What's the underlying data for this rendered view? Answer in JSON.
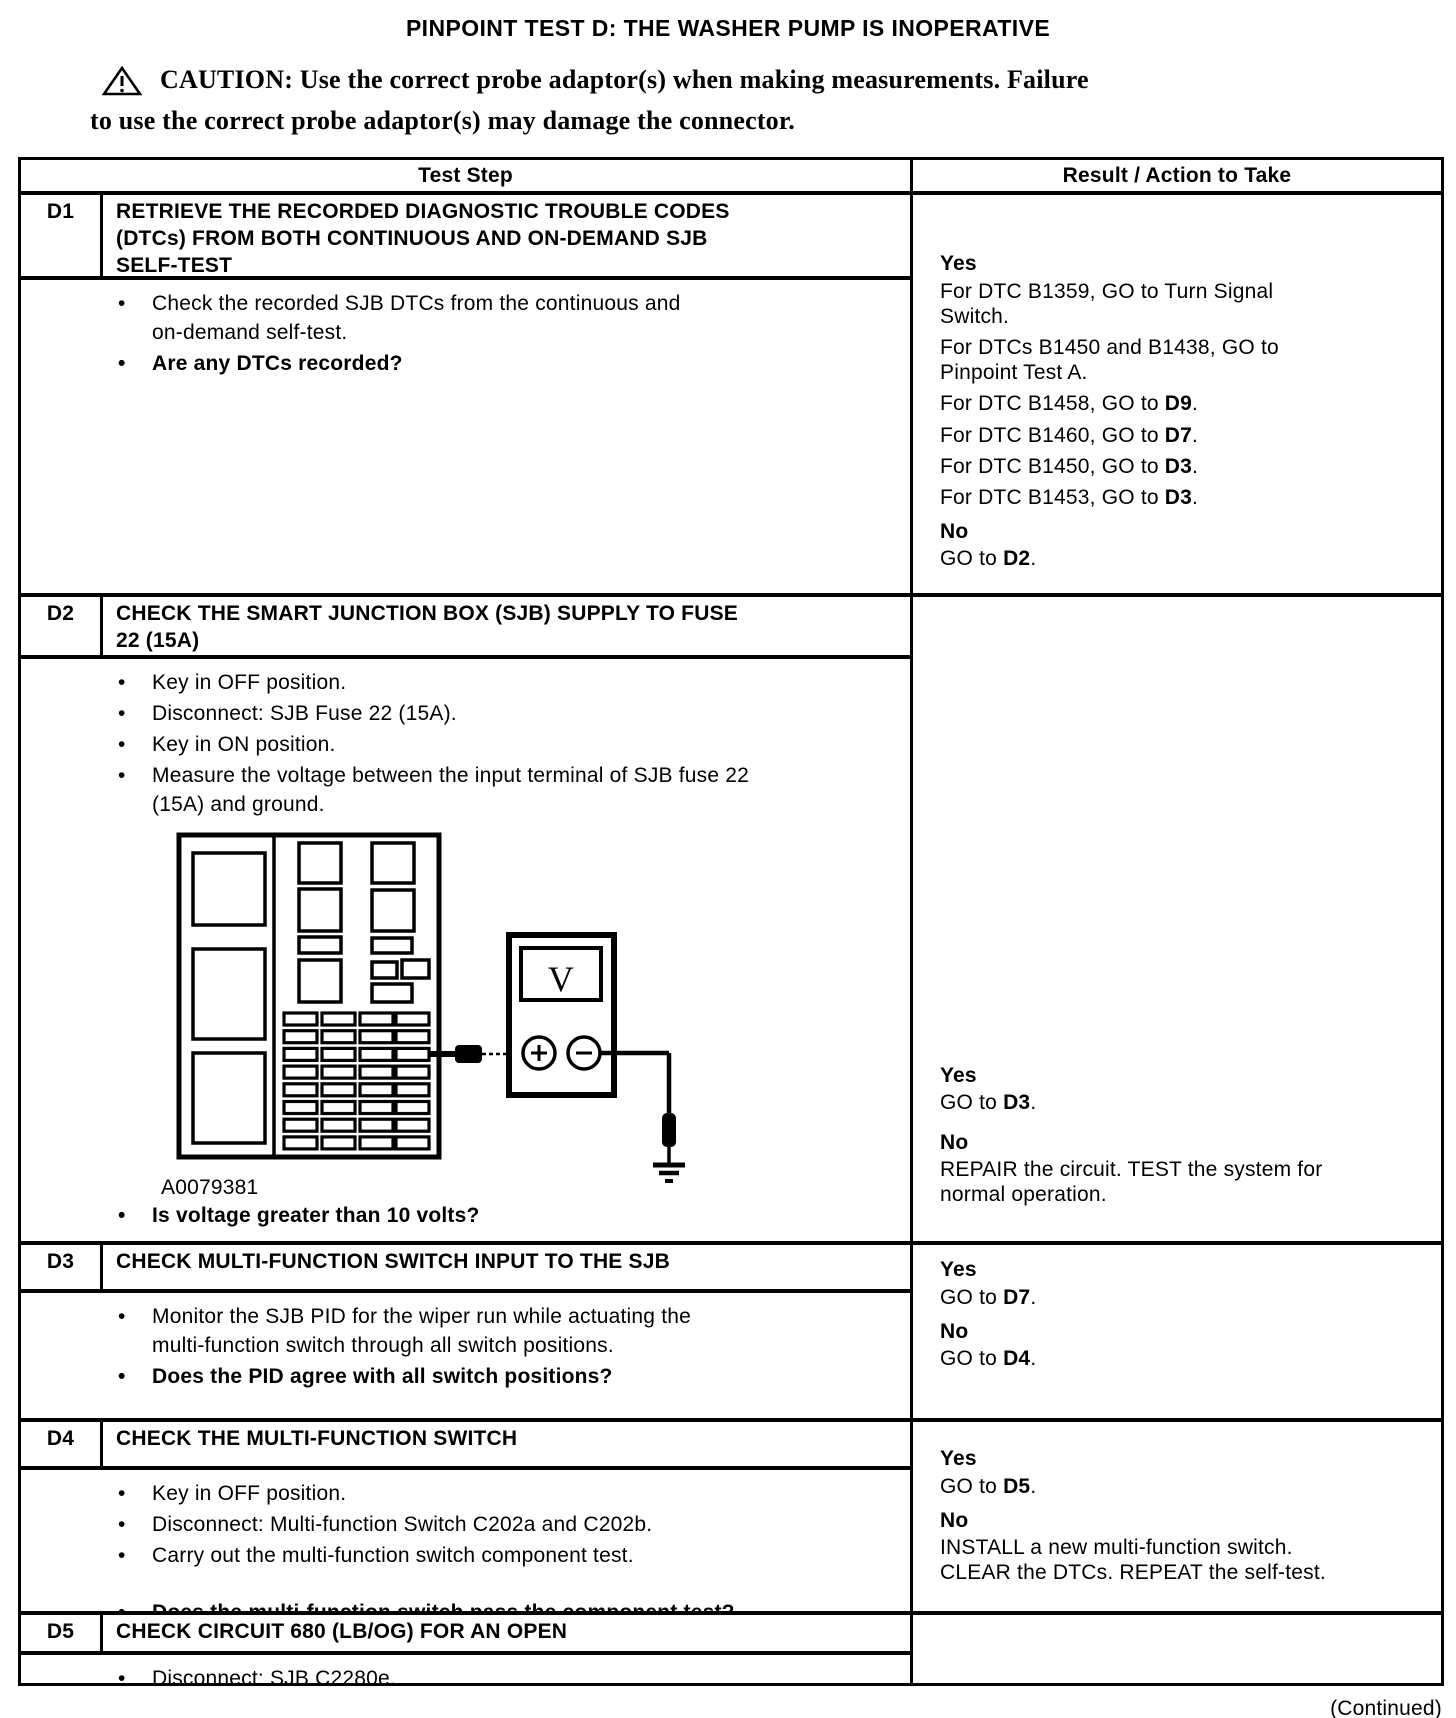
{
  "page": {
    "title": "PINPOINT TEST D: THE WASHER PUMP IS INOPERATIVE",
    "continued": "(Continued)"
  },
  "caution": {
    "line1": "CAUTION: Use the correct probe adaptor(s) when making measurements. Failure",
    "line2": "to use the correct probe adaptor(s) may damage the connector."
  },
  "table": {
    "headers": {
      "test_step": "Test Step",
      "result": "Result / Action to Take"
    },
    "rows": [
      {
        "id": "D1",
        "title": "RETRIEVE THE RECORDED DIAGNOSTIC TROUBLE CODES\n(DTCs) FROM BOTH CONTINUOUS AND ON-DEMAND SJB\nSELF-TEST",
        "steps": [
          {
            "text": "Check the recorded SJB DTCs from the continuous and\non-demand self-test."
          },
          {
            "text": "Are any DTCs recorded?",
            "bold": true
          }
        ],
        "result": [
          {
            "type": "h",
            "text": "Yes"
          },
          {
            "type": "p",
            "segments": [
              {
                "t": "For DTC B1359, GO to Turn Signal\nSwitch."
              }
            ]
          },
          {
            "type": "p",
            "segments": [
              {
                "t": "For DTCs B1450 and B1438, GO to\nPinpoint Test A."
              }
            ]
          },
          {
            "type": "p",
            "segments": [
              {
                "t": "For DTC B1458, GO to "
              },
              {
                "t": "D9",
                "b": true
              },
              {
                "t": "."
              }
            ]
          },
          {
            "type": "p",
            "segments": [
              {
                "t": "For DTC B1460, GO to "
              },
              {
                "t": "D7",
                "b": true
              },
              {
                "t": "."
              }
            ]
          },
          {
            "type": "p",
            "segments": [
              {
                "t": "For DTC B1450, GO to "
              },
              {
                "t": "D3",
                "b": true
              },
              {
                "t": "."
              }
            ]
          },
          {
            "type": "p",
            "segments": [
              {
                "t": "For DTC B1453, GO to "
              },
              {
                "t": "D3",
                "b": true
              },
              {
                "t": "."
              }
            ]
          },
          {
            "type": "h",
            "text": "No"
          },
          {
            "type": "p",
            "segments": [
              {
                "t": "GO to "
              },
              {
                "t": "D2",
                "b": true
              },
              {
                "t": "."
              }
            ]
          }
        ]
      },
      {
        "id": "D2",
        "title": "CHECK THE SMART JUNCTION BOX (SJB) SUPPLY TO FUSE\n22 (15A)",
        "steps": [
          {
            "text": "Key in OFF position."
          },
          {
            "text": "Disconnect: SJB Fuse 22 (15A)."
          },
          {
            "text": "Key in ON position."
          },
          {
            "text": "Measure the voltage between the input terminal of SJB fuse 22\n(15A) and ground."
          }
        ],
        "figure": {
          "caption": "A0079381",
          "meter_label": "V"
        },
        "steps2": [
          {
            "text": "Is voltage greater than 10 volts?",
            "bold": true
          }
        ],
        "result": [
          {
            "type": "h",
            "text": "Yes"
          },
          {
            "type": "p",
            "segments": [
              {
                "t": "GO to "
              },
              {
                "t": "D3",
                "b": true
              },
              {
                "t": "."
              }
            ]
          },
          {
            "type": "h",
            "text": "No"
          },
          {
            "type": "p",
            "segments": [
              {
                "t": "REPAIR the circuit. TEST the system for\nnormal operation."
              }
            ]
          }
        ]
      },
      {
        "id": "D3",
        "title": "CHECK MULTI-FUNCTION SWITCH INPUT TO THE SJB",
        "steps": [
          {
            "text": "Monitor the SJB PID for the wiper run while actuating the\nmulti-function switch through all switch positions."
          },
          {
            "text": "Does the PID agree with all switch positions?",
            "bold": true
          }
        ],
        "result": [
          {
            "type": "h",
            "text": "Yes"
          },
          {
            "type": "p",
            "segments": [
              {
                "t": "GO to "
              },
              {
                "t": "D7",
                "b": true
              },
              {
                "t": "."
              }
            ]
          },
          {
            "type": "h",
            "text": "No"
          },
          {
            "type": "p",
            "segments": [
              {
                "t": "GO to "
              },
              {
                "t": "D4",
                "b": true
              },
              {
                "t": "."
              }
            ]
          }
        ]
      },
      {
        "id": "D4",
        "title": "CHECK THE MULTI-FUNCTION SWITCH",
        "steps": [
          {
            "text": "Key in OFF position."
          },
          {
            "text": "Disconnect: Multi-function Switch C202a and C202b."
          },
          {
            "text": "Carry out the multi-function switch component test."
          },
          {
            "text": "Does the multi-function switch pass the component test?",
            "bold": true,
            "gap": true
          }
        ],
        "result": [
          {
            "type": "h",
            "text": "Yes"
          },
          {
            "type": "p",
            "segments": [
              {
                "t": "GO to "
              },
              {
                "t": "D5",
                "b": true
              },
              {
                "t": "."
              }
            ]
          },
          {
            "type": "h",
            "text": "No"
          },
          {
            "type": "p",
            "segments": [
              {
                "t": "INSTALL a new multi-function switch.\nCLEAR the DTCs. REPEAT the self-test."
              }
            ]
          }
        ]
      },
      {
        "id": "D5",
        "title": "CHECK CIRCUIT 680 (LB/OG) FOR AN OPEN",
        "steps": [
          {
            "text": "Disconnect: SJB C2280e."
          }
        ],
        "result": []
      }
    ]
  }
}
